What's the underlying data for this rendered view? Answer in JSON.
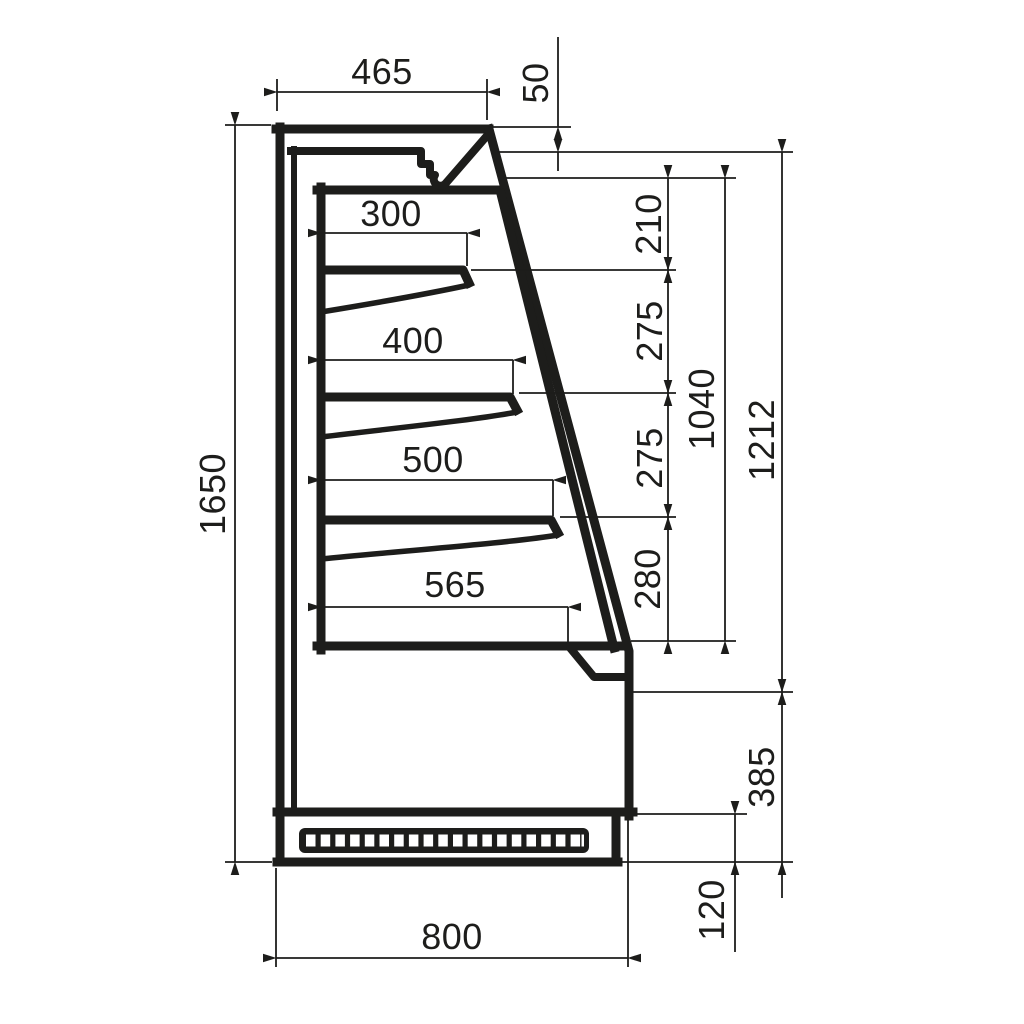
{
  "drawing": {
    "type": "technical-side-section-drawing",
    "subject": "display-cabinet-cross-section",
    "line_color": "#1d1d1b",
    "background_color": "#ffffff"
  },
  "dimensions": {
    "top_depth": "465",
    "canopy_front_height": "50",
    "shelf_depth_1": "300",
    "shelf_depth_2": "400",
    "shelf_depth_3": "500",
    "deck_depth": "565",
    "gap_top": "210",
    "gap_upper": "275",
    "gap_lower": "275",
    "gap_bottom": "280",
    "opening_height": "1040",
    "front_height": "1212",
    "lower_front_height": "385",
    "plinth_height": "120",
    "total_height": "1650",
    "total_depth": "800"
  }
}
